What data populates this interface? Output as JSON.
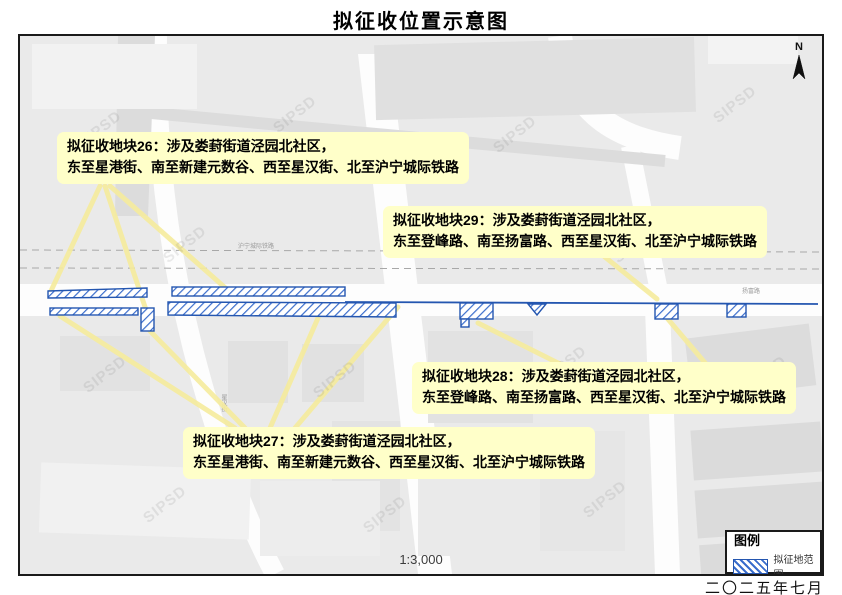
{
  "title": "拟征收位置示意图",
  "date": "二〇二五年七月",
  "map": {
    "scale": "1:3,000",
    "north_label": "N",
    "watermark": "SIPSD",
    "labels": {
      "railway": "沪宁城际铁路",
      "road_south": "扬富路",
      "street_west": "星汉街"
    }
  },
  "legend": {
    "title": "图例",
    "items": [
      {
        "label": "拟征地范围",
        "symbol": "blue-diagonal-hatch"
      }
    ]
  },
  "callouts": {
    "c26": {
      "line1": "拟征收地块26：涉及娄葑街道泾园北社区，",
      "line2": "东至星港街、南至新建元数谷、西至星汉街、北至沪宁城际铁路"
    },
    "c29": {
      "line1": "拟征收地块29：涉及娄葑街道泾园北社区，",
      "line2": "东至登峰路、南至扬富路、西至星汉街、北至沪宁城际铁路"
    },
    "c28": {
      "line1": "拟征收地块28：涉及娄葑街道泾园北社区，",
      "line2": "东至登峰路、南至扬富路、西至星汉街、北至沪宁城际铁路"
    },
    "c27": {
      "line1": "拟征收地块27：涉及娄葑街道泾园北社区，",
      "line2": "东至星港街、南至新建元数谷、西至星汉街、北至沪宁城际铁路"
    }
  },
  "colors": {
    "acquisition_outline": "#2456b0",
    "hatch_blue": "#3a6dcc",
    "callout_bg": "#ffffc9",
    "leader_yellow": "#f6ec9d",
    "frame_black": "#1a1a1a"
  }
}
